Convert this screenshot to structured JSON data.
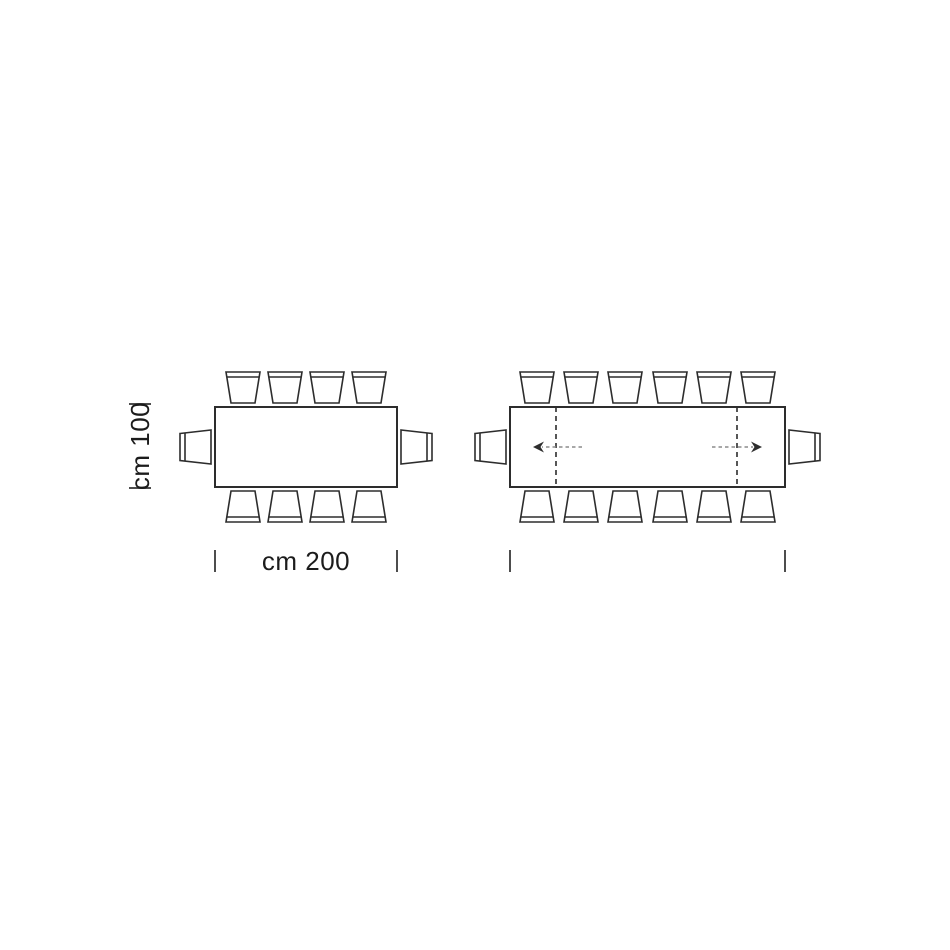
{
  "figure": {
    "canvas": {
      "width": 950,
      "height": 950,
      "background": "#ffffff"
    },
    "style": {
      "line_color": "#2d2d2d",
      "line_width": 2,
      "chair_line_width": 1.6,
      "extension_dash_width": 1.6,
      "extension_dash_array": "5 4",
      "arrow_dash_color": "#8c8c8c",
      "arrow_dash_array": "3.5 3",
      "arrow_dash_width": 1.5,
      "arrow_head_color": "#2d2d2d",
      "tick_color": "#4d4d4d",
      "tick_width": 2,
      "text_color": "#1c1c1c",
      "font_size": 26
    },
    "chair": {
      "seat_back_width": 34,
      "seat_front_width": 24,
      "depth": 31,
      "back_band": 5,
      "gap": 4,
      "side_front_height": 34,
      "side_back_height": 27
    },
    "tables": [
      {
        "id": "table-closed",
        "seats_total": 10,
        "rect": {
          "x": 215,
          "y": 407,
          "w": 182,
          "h": 80
        },
        "chairs_top_cx": [
          243,
          285,
          327,
          369
        ],
        "chairs_bottom_cx": [
          243,
          285,
          327,
          369
        ],
        "chair_left_cy": 447,
        "chair_right_cy": 447,
        "extension_lines_x": [],
        "arrows": [],
        "bottom_ticks_x": [
          215,
          397
        ],
        "ticks_y": {
          "y1": 550,
          "y2": 572
        }
      },
      {
        "id": "table-extended",
        "seats_total": 14,
        "rect": {
          "x": 510,
          "y": 407,
          "w": 275,
          "h": 80
        },
        "chairs_top_cx": [
          537,
          581,
          625,
          670,
          714,
          758
        ],
        "chairs_bottom_cx": [
          537,
          581,
          625,
          670,
          714,
          758
        ],
        "chair_left_cy": 447,
        "chair_right_cy": 447,
        "extension_lines_x": [
          556,
          737
        ],
        "arrows": [
          {
            "x1": 582,
            "x2": 533,
            "y": 447
          },
          {
            "x1": 712,
            "x2": 762,
            "y": 447
          }
        ],
        "bottom_ticks_x": [
          510,
          785
        ],
        "ticks_y": {
          "y1": 550,
          "y2": 572
        }
      }
    ],
    "length_dimension": {
      "label": "cm 200",
      "text_cx": 306,
      "text_cy": 561
    },
    "width_dimension": {
      "label": "cm 100",
      "text_cx": 140,
      "text_cy": 446,
      "ticks": [
        {
          "x1": 129,
          "x2": 151,
          "y": 404
        },
        {
          "x1": 129,
          "x2": 151,
          "y": 488
        }
      ]
    }
  }
}
